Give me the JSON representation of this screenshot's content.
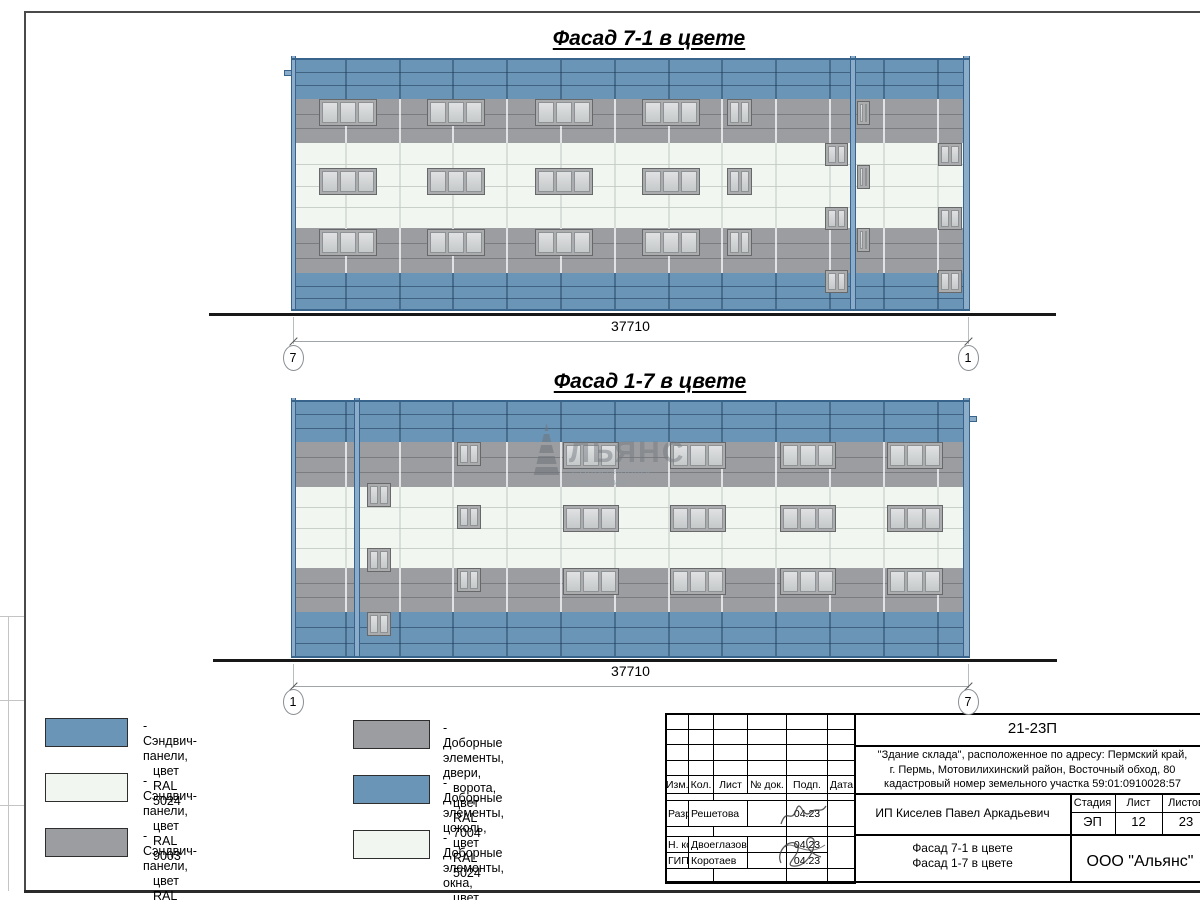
{
  "colors": {
    "blue": "#6b95b6",
    "gray": "#9b9da0",
    "white": "#f2f6f1",
    "blue_seam": "rgba(24,50,78,0.5)",
    "gray_seam": "rgba(70,72,74,0.38)",
    "white_seam": "rgba(160,170,162,0.5)",
    "blue_joint": "rgba(30,58,88,0.45)",
    "gray_joint": "rgba(255,255,255,0.7)",
    "white_joint": "rgba(195,202,196,0.55)",
    "pilaster": "#8badc9",
    "pilaster_edge": "#38648c"
  },
  "facades": [
    {
      "name": "facade-7-1",
      "title": "Фасад 7-1 в цвете",
      "x": 291,
      "y": 58,
      "w": 679,
      "vstep": 53.8,
      "bands": [
        {
          "c": "blue",
          "ral": "5024",
          "h": 41,
          "seams": 2
        },
        {
          "c": "gray",
          "ral": "7004",
          "h": 44,
          "seams": 2
        },
        {
          "c": "white",
          "ral": "9003",
          "h": 85,
          "seams": 3
        },
        {
          "c": "gray",
          "ral": "7004",
          "h": 45,
          "seams": 2
        },
        {
          "c": "blue",
          "ral": "5024",
          "h": 38,
          "seams": 2
        }
      ],
      "pilasters": [
        [
          0,
          5
        ],
        [
          559,
          6
        ],
        [
          672,
          7
        ]
      ],
      "tab": [
        -7,
        12
      ],
      "windows": [
        [
          28,
          41,
          58,
          27,
          3
        ],
        [
          136,
          41,
          58,
          27,
          3
        ],
        [
          244,
          41,
          58,
          27,
          3
        ],
        [
          351,
          41,
          58,
          27,
          3
        ],
        [
          436,
          41,
          25,
          27,
          2
        ],
        [
          566,
          43,
          13,
          24,
          2
        ],
        [
          28,
          110,
          58,
          27,
          3
        ],
        [
          136,
          110,
          58,
          27,
          3
        ],
        [
          244,
          110,
          58,
          27,
          3
        ],
        [
          351,
          110,
          58,
          27,
          3
        ],
        [
          436,
          110,
          25,
          27,
          2
        ],
        [
          534,
          85,
          23,
          23,
          2
        ],
        [
          647,
          85,
          24,
          23,
          2
        ],
        [
          566,
          107,
          13,
          24,
          2
        ],
        [
          28,
          171,
          58,
          27,
          3
        ],
        [
          136,
          171,
          58,
          27,
          3
        ],
        [
          244,
          171,
          58,
          27,
          3
        ],
        [
          351,
          171,
          58,
          27,
          3
        ],
        [
          436,
          171,
          25,
          27,
          2
        ],
        [
          534,
          149,
          23,
          23,
          2
        ],
        [
          647,
          149,
          24,
          23,
          2
        ],
        [
          566,
          170,
          13,
          24,
          2
        ],
        [
          534,
          212,
          23,
          23,
          2
        ],
        [
          647,
          212,
          24,
          23,
          2
        ]
      ],
      "ground": [
        209,
        1056,
        313
      ],
      "dim": {
        "label": "37710",
        "lm": "7",
        "rm": "1",
        "text_y": 318,
        "line_y": 341,
        "marker_y": 345
      }
    },
    {
      "name": "facade-1-7",
      "title": "Фасад 1-7 в цвете",
      "x": 291,
      "y": 400,
      "w": 679,
      "vstep": 53.8,
      "bands": [
        {
          "c": "blue",
          "ral": "5024",
          "h": 42,
          "seams": 2
        },
        {
          "c": "gray",
          "ral": "7004",
          "h": 45,
          "seams": 2
        },
        {
          "c": "white",
          "ral": "9003",
          "h": 81,
          "seams": 3
        },
        {
          "c": "gray",
          "ral": "7004",
          "h": 44,
          "seams": 2
        },
        {
          "c": "blue",
          "ral": "5024",
          "h": 46,
          "seams": 2
        }
      ],
      "pilasters": [
        [
          0,
          5
        ],
        [
          63,
          6
        ],
        [
          672,
          7
        ]
      ],
      "tab": [
        678,
        16
      ],
      "windows": [
        [
          166,
          42,
          24,
          24,
          2
        ],
        [
          272,
          42,
          56,
          27,
          3
        ],
        [
          379,
          42,
          56,
          27,
          3
        ],
        [
          489,
          42,
          56,
          27,
          3
        ],
        [
          596,
          42,
          56,
          27,
          3
        ],
        [
          76,
          83,
          24,
          24,
          2
        ],
        [
          166,
          105,
          24,
          24,
          2
        ],
        [
          272,
          105,
          56,
          27,
          3
        ],
        [
          379,
          105,
          56,
          27,
          3
        ],
        [
          489,
          105,
          56,
          27,
          3
        ],
        [
          596,
          105,
          56,
          27,
          3
        ],
        [
          76,
          148,
          24,
          24,
          2
        ],
        [
          166,
          168,
          24,
          24,
          2
        ],
        [
          272,
          168,
          56,
          27,
          3
        ],
        [
          379,
          168,
          56,
          27,
          3
        ],
        [
          489,
          168,
          56,
          27,
          3
        ],
        [
          596,
          168,
          56,
          27,
          3
        ],
        [
          76,
          212,
          24,
          24,
          2
        ]
      ],
      "ground": [
        213,
        1057,
        659
      ],
      "dim": {
        "label": "37710",
        "lm": "1",
        "rm": "7",
        "text_y": 663,
        "line_y": 686,
        "marker_y": 689
      }
    }
  ],
  "watermark": {
    "text": "ЛЬЯНС",
    "subtitle": "строительная компания"
  },
  "legend": {
    "items": [
      {
        "col": 0,
        "row": 0,
        "c": "blue",
        "ral": "RAL 5024",
        "line1": "- Сэндвич-панели,",
        "line2": "цвет RAL 5024"
      },
      {
        "col": 0,
        "row": 1,
        "c": "white",
        "ral": "RAL 9003",
        "line1": "- Сэндвич-панели,",
        "line2": "цвет RAL 9003"
      },
      {
        "col": 0,
        "row": 2,
        "c": "gray",
        "ral": "RAL 7004",
        "line1": "- Сэндвич-панели,",
        "line2": "цвет RAL 7004"
      },
      {
        "col": 1,
        "row": 0,
        "c": "gray",
        "ral": "RAL 7004",
        "line1": "- Доборные элементы, двери,",
        "line2": "ворота, цвет RAL 7004"
      },
      {
        "col": 1,
        "row": 1,
        "c": "blue",
        "ral": "RAL 5024",
        "line1": "- Доборные элементы, цоколь,",
        "line2": "цвет RAL 5024"
      },
      {
        "col": 1,
        "row": 2,
        "c": "white",
        "ral": "RAL 9003",
        "line1": "- Доборные элементы, окна,",
        "line2": "цвет RAL 9003"
      }
    ]
  },
  "title_block": {
    "code": "21-23П",
    "description": [
      "\"Здание склада\", расположенное по адресу: Пермский край,",
      "г. Пермь, Мотовилихинский район, Восточный обход, 80",
      "кадастровый номер земельного участка 59:01:0910028:57"
    ],
    "columns": [
      "Изм.",
      "Кол.",
      "Лист",
      "№ док.",
      "Подп.",
      "Дата"
    ],
    "signers": [
      {
        "role": "Разраб.",
        "name": "Решетова",
        "date": "04.23"
      },
      {
        "role": "Н. контр.",
        "name": "Двоеглазов",
        "date": "04.23"
      },
      {
        "role": "ГИП",
        "name": "Коротаев",
        "date": "04.23"
      }
    ],
    "client": "ИП Киселев Павел Аркадьевич",
    "stage_columns": [
      "Стадия",
      "Лист",
      "Листов"
    ],
    "stage": "ЭП",
    "sheet": "12",
    "sheets": "23",
    "sheet_titles": [
      "Фасад 7-1 в цвете",
      "Фасад 1-7 в цвете"
    ],
    "company": "ООО \"Альянс\""
  }
}
